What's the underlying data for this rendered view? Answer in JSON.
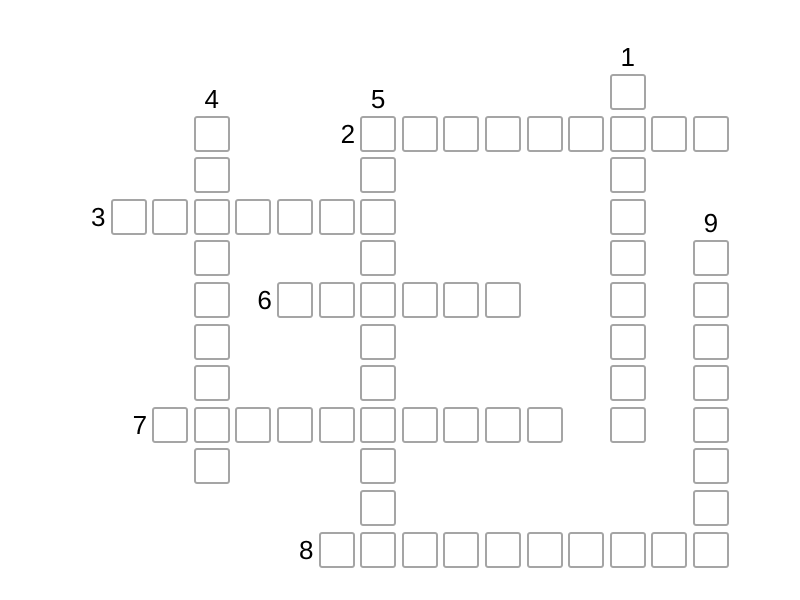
{
  "puzzle": {
    "type": "crossword",
    "background_color": "#ffffff",
    "cell_fill_color": "#ffffff",
    "cell_border_color": "#a5a5a5",
    "number_color": "#000000",
    "cells_are_empty": true,
    "words": [
      {
        "number": "1",
        "direction": "down",
        "col": 12,
        "row": 0,
        "length": 9
      },
      {
        "number": "2",
        "direction": "across",
        "col": 6,
        "row": 1,
        "length": 9
      },
      {
        "number": "3",
        "direction": "across",
        "col": 0,
        "row": 3,
        "length": 7
      },
      {
        "number": "4",
        "direction": "down",
        "col": 2,
        "row": 1,
        "length": 9
      },
      {
        "number": "5",
        "direction": "down",
        "col": 6,
        "row": 1,
        "length": 11
      },
      {
        "number": "6",
        "direction": "across",
        "col": 4,
        "row": 5,
        "length": 6
      },
      {
        "number": "7",
        "direction": "across",
        "col": 1,
        "row": 8,
        "length": 10
      },
      {
        "number": "8",
        "direction": "across",
        "col": 5,
        "row": 11,
        "length": 10
      },
      {
        "number": "9",
        "direction": "down",
        "col": 14,
        "row": 4,
        "length": 8
      }
    ]
  }
}
